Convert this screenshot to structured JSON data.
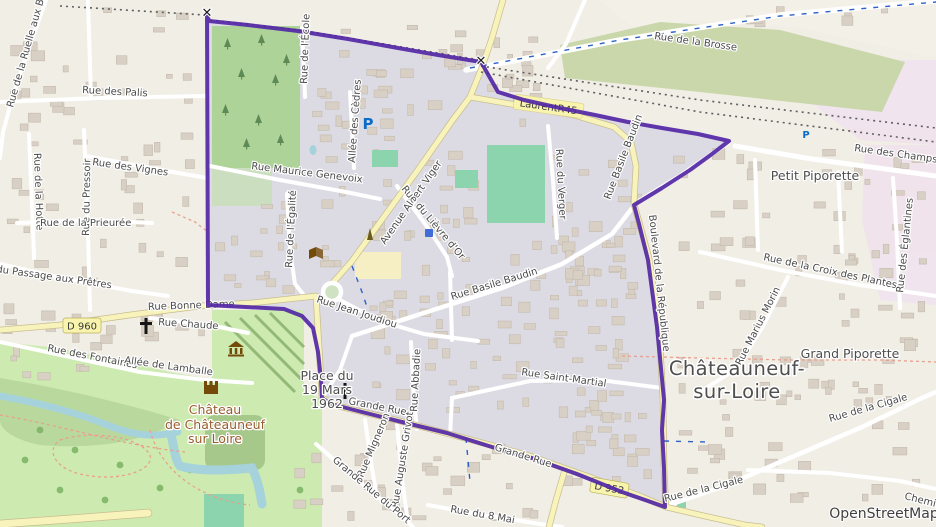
{
  "labels": {
    "ruelle_aux_bois": "Rue de la Ruelle aux Bois",
    "palis": "Rue des Palis",
    "hotte": "Rue de la Hotte",
    "pressoir": "Rue du Pressoir",
    "vignes": "Rue des Vignes",
    "prieuree": "Rue de la Prieurée",
    "passage_pretres": "Rue du Passage aux Prêtres",
    "bonne_dame": "Rue Bonne Dame",
    "d960": "D 960",
    "chaude": "Rue Chaude",
    "fontaines": "Rue des Fontaines",
    "lamballe": "Allée de Lamballe",
    "genevoix": "Rue Maurice Genevoix",
    "cedres": "Allée des Cèdres",
    "ecole": "Rue de l'École",
    "egalite": "Rue de l'Égalité",
    "avenue_viger": "Avenue Albert Viger",
    "lievre_dor": "Rue du Lièvre d'Or",
    "jean_joudiou": "Rue Jean Joudiou",
    "basile_baudin_c": "Rue Basile Baudin",
    "basile_baudin_ne": "Rue Basile Baudin",
    "verger": "Rue du Verger",
    "saint_martial": "Rue Saint-Martial",
    "abbadie": "Rue Abbadie",
    "migneron": "Rue Migneron",
    "grivot": "Rue Auguste Grivot",
    "port": "Grande Rue du Port",
    "mai8": "Rue du 8 Mai",
    "grande_rue": "Grande Rue",
    "grande_rue2": "Grande Rue",
    "d952": "D 952",
    "laurent": "LaurentR45",
    "brosse": "Rue de la Brosse",
    "champs": "Rue des Champs",
    "petit_piporette": "Petit Piporette",
    "grand_piporette": "Grand Piporette",
    "croix_plantes": "Rue de la Croix des Plantes",
    "eglantines": "Rue des Églantines",
    "marius_morin": "Rue Marius Morin",
    "cigale1": "Rue de la Cigale",
    "cigale2": "Rue de la Cigale",
    "chemin": "Chemin",
    "boulevard": "Boulevard de la République",
    "town1": "Châteauneuf-",
    "town2": "sur-Loire",
    "place1": "Place du",
    "place2": "19 Mars",
    "place3": "1962",
    "chateau1": "Château",
    "chateau2": "de Châteauneuf",
    "chateau3": "sur Loire",
    "osm": "OpenStreetMap"
  },
  "icons": {
    "x_marker": "✕",
    "parking": "P"
  },
  "colors": {
    "boundary": "#5227a5",
    "residential": "#dcdbe4",
    "water": "#a6d2dc",
    "park": "#cdebb0",
    "wood": "#aed398",
    "scrub": "#c9d7ab",
    "pitch": "#8bd4ae",
    "road_yellow": "#f7f3bb",
    "building": "#d8cfc5",
    "industrial": "#f0e2ee"
  }
}
